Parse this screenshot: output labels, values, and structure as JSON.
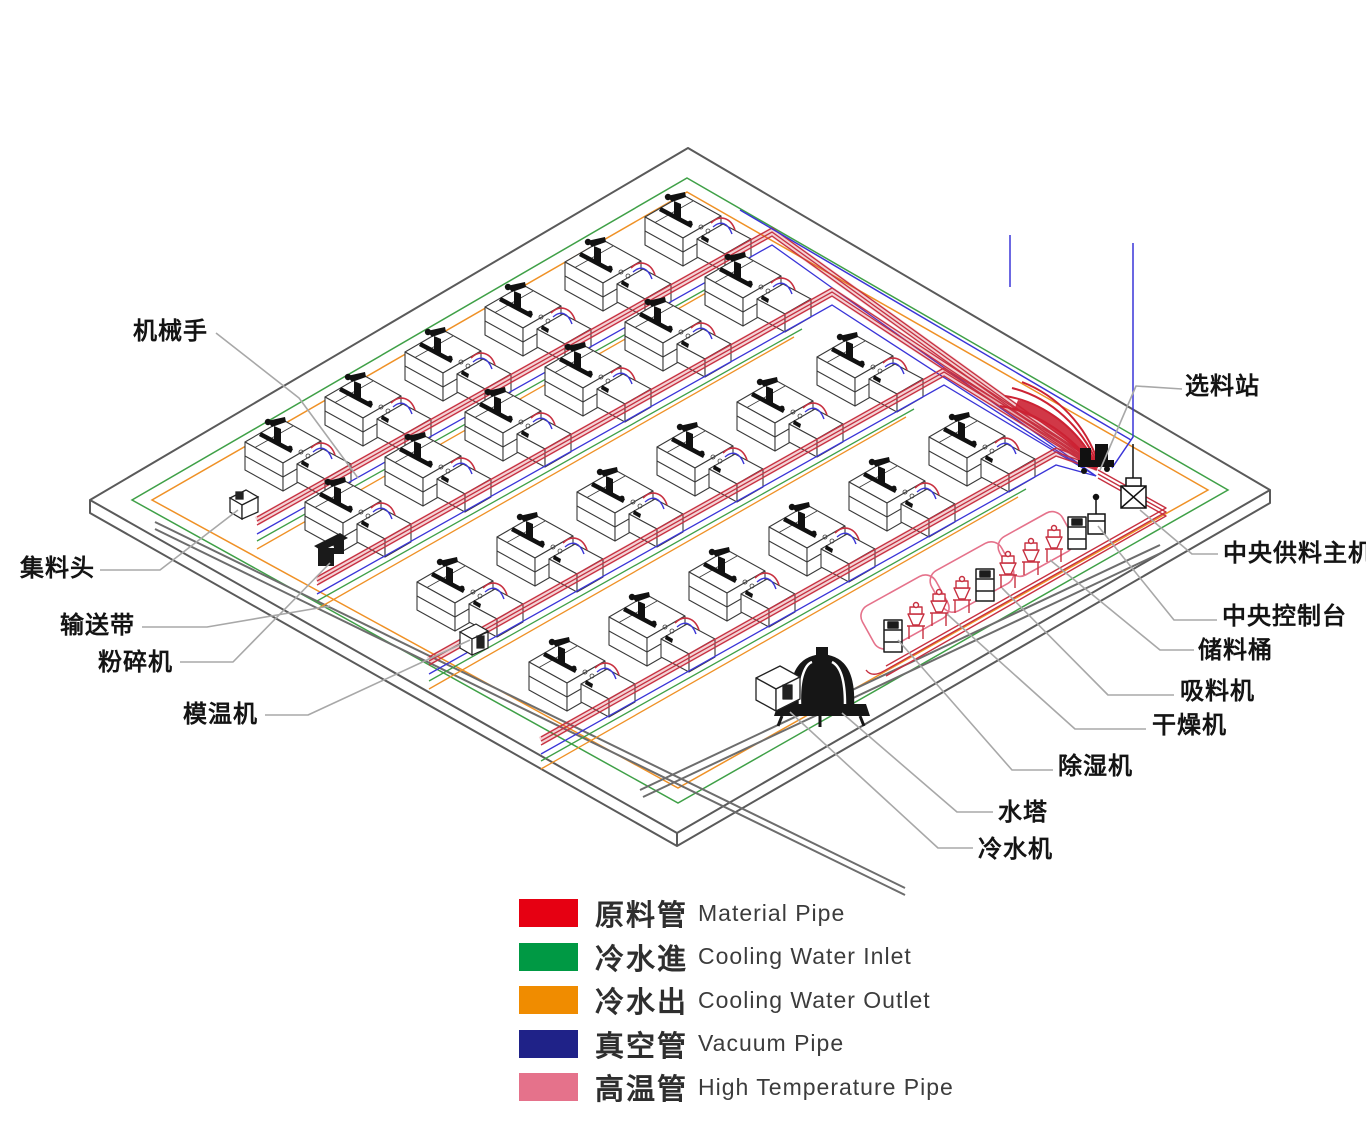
{
  "title": "Central feeding system isometric factory diagram",
  "labels": [
    {
      "id": "robot-arm",
      "text": "机械手"
    },
    {
      "id": "material-selection-station",
      "text": "选料站"
    },
    {
      "id": "collection-head",
      "text": "集料头"
    },
    {
      "id": "conveyor-belt",
      "text": "输送带"
    },
    {
      "id": "crusher",
      "text": "粉碎机"
    },
    {
      "id": "mold-temp-controller",
      "text": "模温机"
    },
    {
      "id": "central-feeding-main-unit",
      "text": "中央供料主机"
    },
    {
      "id": "central-control-console",
      "text": "中央控制台"
    },
    {
      "id": "storage-barrel",
      "text": "储料桶"
    },
    {
      "id": "suction-machine",
      "text": "吸料机"
    },
    {
      "id": "dryer",
      "text": "干燥机"
    },
    {
      "id": "dehumidifier",
      "text": "除湿机"
    },
    {
      "id": "water-tower",
      "text": "水塔"
    },
    {
      "id": "chiller",
      "text": "冷水机"
    }
  ],
  "legend": {
    "items": [
      {
        "color": "#e60012",
        "zh": "原料管",
        "en": "Material Pipe"
      },
      {
        "color": "#009944",
        "zh": "冷水進",
        "en": "Cooling Water Inlet"
      },
      {
        "color": "#f08c00",
        "zh": "冷水出",
        "en": "Cooling Water Outlet"
      },
      {
        "color": "#1f2288",
        "zh": "真空管",
        "en": "Vacuum Pipe"
      },
      {
        "color": "#e5728b",
        "zh": "高温管",
        "en": "High Temperature Pipe"
      }
    ]
  },
  "pipe_colors": {
    "material": "#c73040",
    "cooling_inlet": "#3fa047",
    "cooling_outlet": "#ef9126",
    "vacuum": "#3a35d8",
    "high_temperature": "#e5728b"
  }
}
